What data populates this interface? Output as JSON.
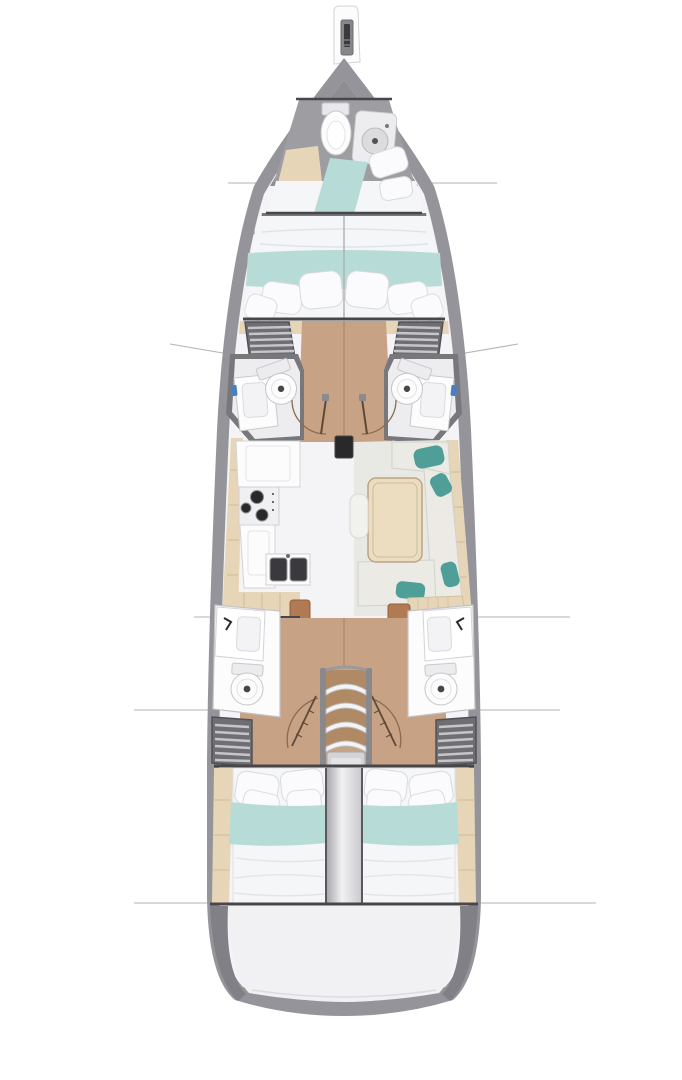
{
  "diagram": {
    "type": "yacht-interior-deck-plan",
    "orientation": "bow-top",
    "canvas": {
      "width": 682,
      "height": 1080
    },
    "rooms": [
      {
        "name": "forepeak-head",
        "features": [
          "toilet",
          "shower",
          "counter",
          "berth"
        ]
      },
      {
        "name": "owner-cabin",
        "features": [
          "double-bed",
          "pillows",
          "teal-runner"
        ]
      },
      {
        "name": "mid-head-port",
        "features": [
          "sink",
          "toilet",
          "locker",
          "door"
        ]
      },
      {
        "name": "mid-head-starboard",
        "features": [
          "sink",
          "toilet",
          "locker",
          "door"
        ]
      },
      {
        "name": "galley",
        "features": [
          "fridge",
          "stove",
          "double-sink",
          "counters"
        ]
      },
      {
        "name": "salon",
        "features": [
          "l-sofa",
          "table",
          "pouf",
          "nav-desk",
          "nav-seat"
        ]
      },
      {
        "name": "companionway",
        "features": [
          "stairs",
          "platform"
        ]
      },
      {
        "name": "aft-head-port",
        "features": [
          "sink",
          "toilet",
          "locker",
          "door"
        ]
      },
      {
        "name": "aft-head-starboard",
        "features": [
          "sink",
          "toilet",
          "locker",
          "door"
        ]
      },
      {
        "name": "aft-cabin-port",
        "features": [
          "double-bed",
          "pillows",
          "teal-runner"
        ]
      },
      {
        "name": "aft-cabin-starboard",
        "features": [
          "double-bed",
          "pillows",
          "teal-runner"
        ]
      },
      {
        "name": "transom",
        "features": [
          "swim-deck"
        ]
      }
    ],
    "fixtures": {
      "stove_burners": 3,
      "stair_treads": 4,
      "locker_slats": 6,
      "section_lines_y": [
        183,
        351,
        617,
        710,
        903
      ],
      "mast": true,
      "bowsprit_anchor": true
    },
    "palette": {
      "page": "#ffffff",
      "hull": "#94949a",
      "hullDark": "#6b6b70",
      "deck": "#f4f4f6",
      "bowShadow": "#8d8d92",
      "wallDark": "#47474b",
      "interiorShadow": "#77777c",
      "wood": "#c7a284",
      "woodSeam": "#a5805f",
      "woodLight": "#e7d5b7",
      "teal": "#b7dbd6",
      "tealDark": "#4f9e97",
      "bedWhite": "#f5f6f8",
      "pillow": "#fbfbfd",
      "cushion": "#ebeae5",
      "salonFloor": "#e8e9e4",
      "tableWood": "#ecdcc0",
      "brown": "#b27a52",
      "locker": "#6e6e73",
      "lockerSlat": "#c6c6ca",
      "fixtureWhite": "#fcfcfd",
      "basinDark": "#3a3a3e",
      "dark": "#29292c",
      "blue": "#4a7fc1",
      "sectionLine": "#b3b3b6",
      "stairTread": "#f4f4f5",
      "platform": "#d4d4d7",
      "doorArc": "#8a6b50",
      "doorLeaf": "#5d4a38"
    }
  }
}
